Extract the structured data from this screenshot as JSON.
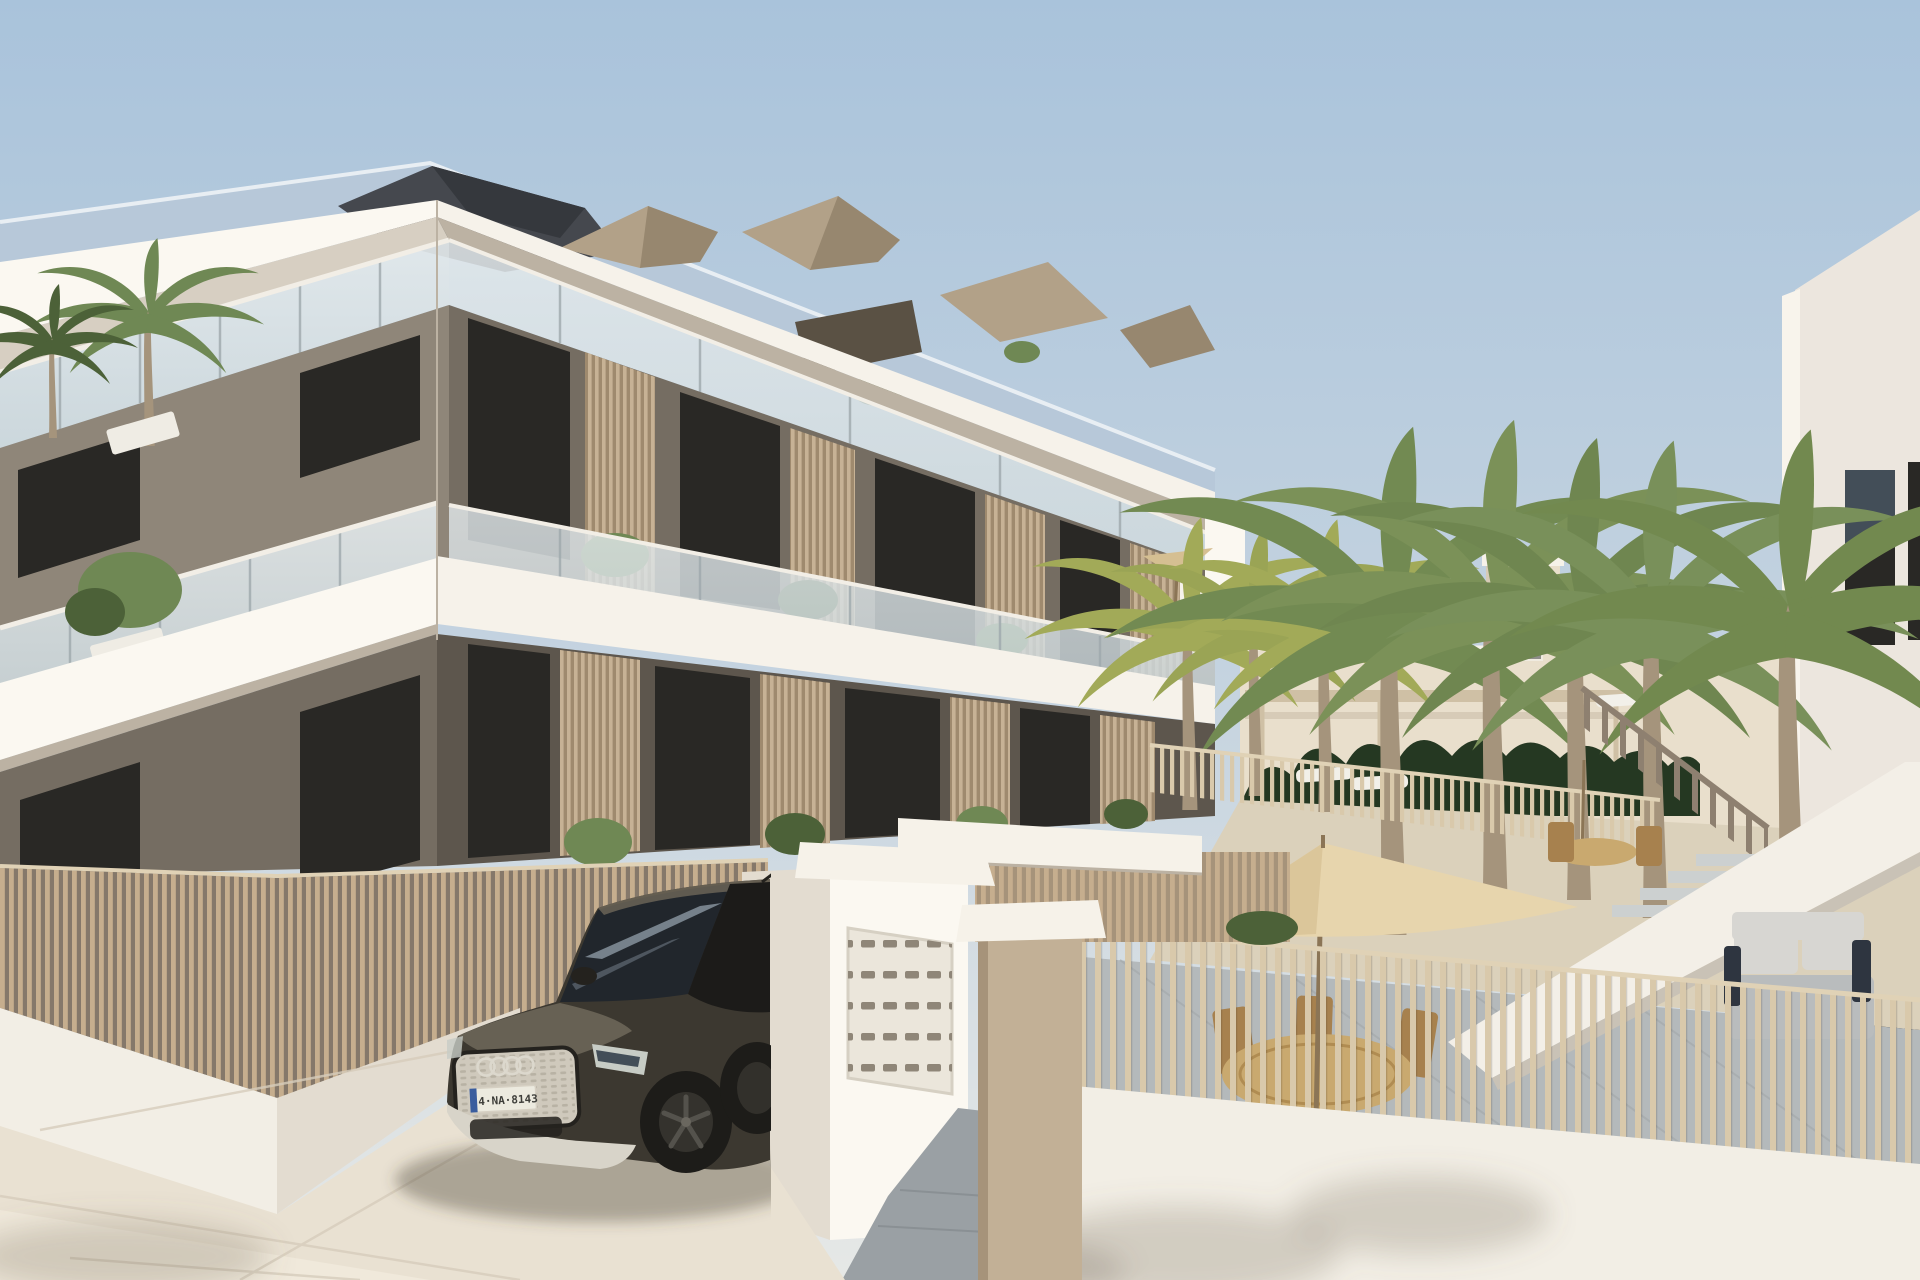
{
  "meta": {
    "title": "New-build apartment complex – exterior architectural render",
    "scene_type": "3D visualization, daytime, clear sky"
  },
  "vehicle": {
    "type": "SUV parked at entrance",
    "brand_badge": "four-rings",
    "body_color_name": "dark umbra metallic",
    "license_plate": "4·NA·8143"
  },
  "scene": {
    "main_building": {
      "storeys": 3,
      "style": "white cantilevered slabs, taupe walls, glass balcony railings, timber louver dividers, roof terrace with plants",
      "roof": "dark slate ridge with glazed sloping edge"
    },
    "entrance": {
      "mailbox_rows": 5,
      "mailbox_cols": 6,
      "elements": [
        "white mailbox wall",
        "white cap lintels",
        "sand pillar",
        "grey ramp"
      ]
    },
    "courtyard": {
      "tall_palms": 5,
      "small_palms": 3,
      "furniture": [
        "tan parasols",
        "rattan dining table",
        "wooden chairs",
        "white sun loungers",
        "grey garden sofa"
      ],
      "hedge": "dark green privacy hedge",
      "fences": "vertical timber slat fences on white walls"
    },
    "right_building": "white block with dark window openings and external staircase with white parapet"
  },
  "palette": {
    "sky_top": "#a9c3db",
    "sky_mid": "#c6d4e0",
    "sky_horizon": "#e6e8e6",
    "roof_glass": "#b7c8d9",
    "roof_glass_edge": "#e8eef3",
    "roof_slate": "#45484e",
    "roof_slate_dark": "#35383d",
    "roof_tan": "#b2a188",
    "roof_tan_dark": "#97876f",
    "awning_dark": "#5a5144",
    "slab_white": "#f6f2ea",
    "slab_bright": "#fbf8f1",
    "soffit": "#d7cfc2",
    "soffit_dark": "#bcb2a3",
    "wall_taupe": "#8f8679",
    "wall_taupe_dark": "#756d62",
    "wall_taupe_deep": "#5d564d",
    "window_dark": "#292825",
    "window_frame": "#1c1b19",
    "window_refl": "#434e58",
    "glass_a": "#cdd8dc",
    "glass_b": "#e4eaec",
    "rail_white": "#f2eee6",
    "rail_post": "#9fa9ad",
    "louver_light": "#c7b295",
    "louver_shade": "#9f8a6e",
    "planter_white": "#efece4",
    "plant_green": "#6f8854",
    "plant_deep": "#4c6138",
    "plant_yellow": "#a2aa58",
    "palm_trunk": "#a5947c",
    "hedge_green": "#253822",
    "bgwall_lit": "#e9dfcc",
    "bgwall_shade": "#d7cbb7",
    "tower_window": "#8e8d89",
    "pergola": "#cfc0a5",
    "lounger_white": "#f2f0e9",
    "ground_sand": "#dbd1bb",
    "rb_face": "#ece6de",
    "rb_edge": "#f8f4ec",
    "rb_shade": "#d9d2c8",
    "stair_white": "#f3efe7",
    "stair_shade": "#c9c2b6",
    "baluster_wood": "#8e8070",
    "step_gray": "#ccd0d0",
    "patio_gray": "#b4b9bb",
    "patio_line": "#a2a7a9",
    "sofa_cushion": "#d7d6d2",
    "sofa_base": "#b9bcbd",
    "sofa_dark": "#2e3540",
    "umbrella_tan": "#e7d5ad",
    "umbrella_shade": "#d5bf92",
    "pole_brown": "#8b7556",
    "table_rattan": "#c9a96f",
    "table_edge": "#b08c52",
    "chair_wood": "#a7814e",
    "fence_slat": "#c6ae8e",
    "fence_slat_light": "#d9c9ab",
    "fence_gap": "#85786a",
    "fence_rail": "#e0d2b6",
    "base_white": "#f2eee5",
    "base_shade": "#e3dcd0",
    "cap_white": "#f6f2e9",
    "pillar_tan": "#c2b096",
    "pillar_shade": "#a6937a",
    "mail_panel": "#ebe6db",
    "mail_slot": "#8f8678",
    "mail_border": "#d6d0c3",
    "ramp_gray": "#9aa0a4",
    "ramp_line": "#8a9094",
    "pave": "#e9e1d2",
    "pave_bright": "#f0e9db",
    "pave_line": "#d7cdbc",
    "car_body": "#3c3830",
    "car_body_hi": "#6f685a",
    "car_body_deep": "#24221e",
    "car_glass": "#21262c",
    "car_glass_hi": "#a4b2bf",
    "car_trim": "#d9d5ca",
    "grille_bg": "#cfc9bc",
    "grille_dot": "#b5afa1",
    "ring_silver": "#dcd8cd",
    "plate_white": "#eceadf",
    "plate_blue": "#3a5d9e",
    "plate_ink": "#3e3e3a",
    "headlight": "#c7ccc5",
    "wheel_dark": "#1d1c19",
    "wheel_rim": "#54524c",
    "bumper_silver": "#d8d4c9",
    "shadow_soft": "rgba(70,62,50,0.38)",
    "shadow_tree": "rgba(115,104,88,0.25)"
  }
}
